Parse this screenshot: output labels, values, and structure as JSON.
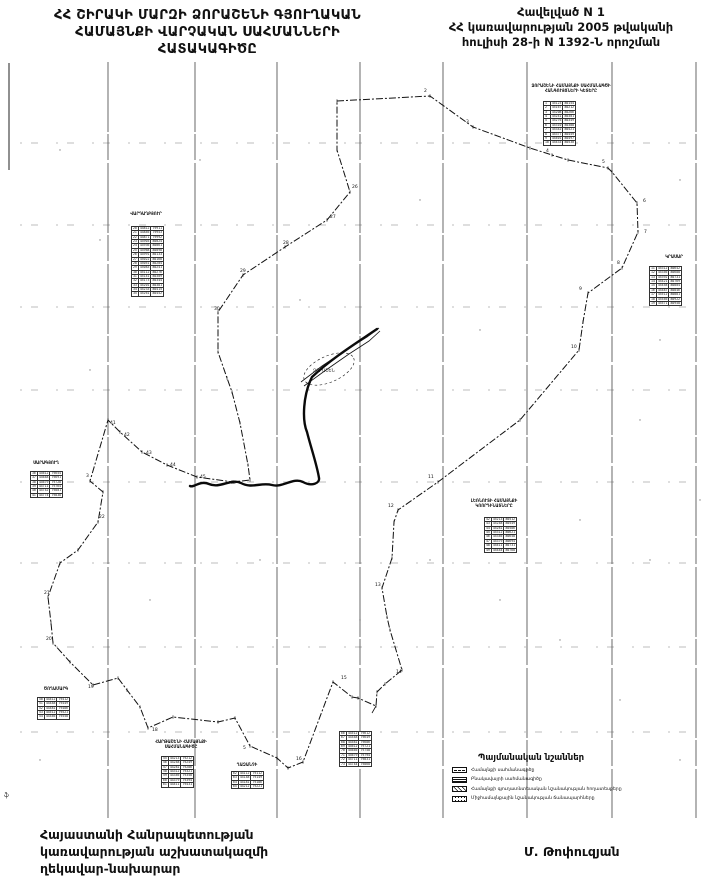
{
  "page": {
    "title_lines": [
      "ՀՀ ՇԻՐԱԿԻ ՄԱՐԶԻ ՁՈՐԱՇԵՆԻ ԳՅՈՒՂԱԿԱՆ",
      "ՀԱՄԱՅՆՔԻ ՎԱՐՉԱԿԱՆ  ՍԱՀՄԱՆՆԵՐԻ",
      "ՀԱՏԱԿԱԳԻԾԸ"
    ],
    "annex_lines": [
      "Հավելված N 1",
      "ՀՀ կառավարության 2005 թվականի",
      "հուլիսի 28-ի N 1392-Ն որոշման"
    ],
    "footer_left_lines": [
      "Հայաստանի Հանրապետության",
      "կառավարության աշխատակազմի",
      "ղեկավար-նախարար"
    ],
    "signature": "Մ. Թոփուզյան",
    "edge_mark": "ֆ"
  },
  "map": {
    "village_label": "ՁՈՐԱՇԵՆ",
    "grid": {
      "vertical_x": [
        108,
        195,
        277,
        360,
        443,
        527,
        612,
        696
      ],
      "v_top": 62,
      "v_bottom": 818,
      "horizontal_y": [
        143,
        225,
        307,
        390,
        482,
        563,
        647,
        732
      ]
    },
    "boundary": [
      [
        337,
        101
      ],
      [
        430,
        96
      ],
      [
        473,
        127
      ],
      [
        530,
        148
      ],
      [
        552,
        155
      ],
      [
        568,
        160
      ],
      [
        608,
        168
      ],
      [
        612,
        172
      ],
      [
        637,
        203
      ],
      [
        638,
        232
      ],
      [
        622,
        268
      ],
      [
        588,
        293
      ],
      [
        583,
        322
      ],
      [
        579,
        350
      ],
      [
        520,
        420
      ],
      [
        438,
        482
      ],
      [
        398,
        510
      ],
      [
        394,
        522
      ],
      [
        392,
        558
      ],
      [
        382,
        588
      ],
      [
        387,
        617
      ],
      [
        390,
        630
      ],
      [
        402,
        670
      ],
      [
        385,
        684
      ],
      [
        377,
        692
      ],
      [
        376,
        706
      ],
      [
        358,
        698
      ],
      [
        352,
        697
      ],
      [
        333,
        682
      ],
      [
        303,
        762
      ],
      [
        288,
        768
      ],
      [
        277,
        758
      ],
      [
        250,
        746
      ],
      [
        235,
        718
      ],
      [
        218,
        722
      ],
      [
        173,
        717
      ],
      [
        148,
        728
      ],
      [
        140,
        707
      ],
      [
        127,
        690
      ],
      [
        118,
        678
      ],
      [
        93,
        685
      ],
      [
        70,
        662
      ],
      [
        53,
        643
      ],
      [
        51,
        623
      ],
      [
        48,
        597
      ],
      [
        60,
        563
      ],
      [
        78,
        550
      ],
      [
        98,
        522
      ],
      [
        103,
        492
      ],
      [
        90,
        481
      ],
      [
        108,
        420
      ],
      [
        120,
        432
      ],
      [
        142,
        452
      ],
      [
        167,
        465
      ],
      [
        197,
        477
      ],
      [
        233,
        482
      ],
      [
        250,
        480
      ],
      [
        248,
        465
      ],
      [
        240,
        423
      ],
      [
        232,
        392
      ],
      [
        227,
        378
      ],
      [
        218,
        352
      ],
      [
        218,
        312
      ],
      [
        243,
        275
      ],
      [
        285,
        247
      ],
      [
        327,
        220
      ],
      [
        350,
        192
      ],
      [
        337,
        150
      ]
    ],
    "bold_paths": [
      "M377,329 C358,342 332,358 312,377 C303,395 302,420 307,432 C311,448 317,465 319,478 C320,483 312,487 303,482 C293,477 283,488 272,485 C261,482 252,489 241,483 C231,478 220,489 209,484 C200,480 194,488 190,486"
    ],
    "thin_paths": [
      "M301,382 L322,366 L346,350 L367,337 L379,328",
      "M304,386 L326,370 L349,354 L369,341 L380,331",
      "M376,706 L372,713"
    ],
    "village_ellipse": {
      "cx": 329,
      "cy": 369,
      "rx": 27,
      "ry": 13,
      "rot": -24
    },
    "point_labels": [
      [
        424,
        92,
        "2"
      ],
      [
        466,
        123,
        "3"
      ],
      [
        546,
        152,
        "4"
      ],
      [
        602,
        163,
        "5"
      ],
      [
        643,
        202,
        "6"
      ],
      [
        644,
        233,
        "7"
      ],
      [
        617,
        264,
        "8"
      ],
      [
        579,
        290,
        "9"
      ],
      [
        571,
        348,
        "10"
      ],
      [
        428,
        478,
        "11"
      ],
      [
        388,
        507,
        "12"
      ],
      [
        375,
        586,
        "13"
      ],
      [
        396,
        673,
        "14"
      ],
      [
        341,
        679,
        "15"
      ],
      [
        296,
        760,
        "16"
      ],
      [
        243,
        749,
        "5"
      ],
      [
        152,
        731,
        "18"
      ],
      [
        88,
        688,
        "19"
      ],
      [
        46,
        640,
        "20"
      ],
      [
        44,
        594,
        "21"
      ],
      [
        99,
        518,
        "22"
      ],
      [
        86,
        477,
        "3"
      ],
      [
        110,
        424,
        "41"
      ],
      [
        124,
        436,
        "42"
      ],
      [
        146,
        454,
        "43"
      ],
      [
        170,
        466,
        "44"
      ],
      [
        200,
        478,
        "45"
      ],
      [
        230,
        484,
        "46"
      ],
      [
        214,
        310,
        "30"
      ],
      [
        240,
        272,
        "29"
      ],
      [
        283,
        244,
        "28"
      ],
      [
        330,
        218,
        "27"
      ],
      [
        352,
        188,
        "26"
      ]
    ],
    "noise_dots": [
      [
        60,
        150
      ],
      [
        420,
        200
      ],
      [
        660,
        340
      ],
      [
        640,
        420
      ],
      [
        90,
        370
      ],
      [
        300,
        300
      ],
      [
        500,
        600
      ],
      [
        620,
        700
      ],
      [
        680,
        760
      ],
      [
        150,
        600
      ],
      [
        260,
        560
      ],
      [
        430,
        560
      ],
      [
        560,
        640
      ],
      [
        700,
        500
      ],
      [
        40,
        760
      ],
      [
        680,
        180
      ],
      [
        200,
        160
      ],
      [
        580,
        520
      ],
      [
        360,
        620
      ],
      [
        100,
        240
      ],
      [
        650,
        560
      ],
      [
        480,
        330
      ]
    ],
    "edge_line": {
      "x": 9,
      "y1": 63,
      "y2": 170
    }
  },
  "tables": [
    {
      "hx": 525,
      "hy": 84,
      "hw": 92,
      "header_lines": [
        "ՁՈՐԱՇԵՆԻ ՀԱՄԱՅՆՔԻ ՍԱՀՄԱՆԱԳԾԻ",
        "ՀԱՆԳՈՒՅՑՆԵՐԻ ԿԵՏԵՐԸ"
      ],
      "tx": 543,
      "ty": 101,
      "rows": [
        [
          "1",
          "45123",
          "80154"
        ],
        [
          "2",
          "45167",
          "80212"
        ],
        [
          "3",
          "45208",
          "80266"
        ],
        [
          "4",
          "45241",
          "80301"
        ],
        [
          "5",
          "45276",
          "80349"
        ],
        [
          "6",
          "45310",
          "80388"
        ],
        [
          "7",
          "45342",
          "80421"
        ],
        [
          "8",
          "45377",
          "80459"
        ],
        [
          "9",
          "45401",
          "80497"
        ],
        [
          "10",
          "45433",
          "80530"
        ]
      ]
    },
    {
      "hx": 648,
      "hy": 255,
      "hw": 52,
      "header_lines": [
        "ԿՐԱՍԱՐ"
      ],
      "tx": 649,
      "ty": 266,
      "rows": [
        [
          "11",
          "45312",
          "80642"
        ],
        [
          "12",
          "45356",
          "80688"
        ],
        [
          "13",
          "45392",
          "80731"
        ],
        [
          "14",
          "45421",
          "80769"
        ],
        [
          "15",
          "45458",
          "80804"
        ],
        [
          "16",
          "45487",
          "80846"
        ],
        [
          "17",
          "45512",
          "80881"
        ],
        [
          "18",
          "45546",
          "80922"
        ],
        [
          "19",
          "45571",
          "80958"
        ]
      ]
    },
    {
      "hx": 122,
      "hy": 212,
      "hw": 48,
      "header_lines": [
        "ՎԱՐԴԱՂԲՅՈՒՐ"
      ],
      "tx": 131,
      "ty": 226,
      "rows": [
        [
          "20",
          "44812",
          "79911"
        ],
        [
          "21",
          "44846",
          "79953"
        ],
        [
          "22",
          "44871",
          "79992"
        ],
        [
          "23",
          "44903",
          "80024"
        ],
        [
          "24",
          "44936",
          "80061"
        ],
        [
          "25",
          "44968",
          "80098"
        ],
        [
          "26",
          "44991",
          "80133"
        ],
        [
          "27",
          "45022",
          "80168"
        ],
        [
          "28",
          "45051",
          "80204"
        ],
        [
          "29",
          "45083",
          "80241"
        ],
        [
          "30",
          "45112",
          "80276"
        ],
        [
          "31",
          "45141",
          "80309"
        ],
        [
          "32",
          "45173",
          "80344"
        ],
        [
          "33",
          "45201",
          "80381"
        ],
        [
          "34",
          "45233",
          "80415"
        ],
        [
          "35",
          "45261",
          "80452"
        ]
      ]
    },
    {
      "hx": 24,
      "hy": 461,
      "hw": 44,
      "header_lines": [
        "ՍԱՐԱԳՅՈՒՂ"
      ],
      "tx": 30,
      "ty": 471,
      "rows": [
        [
          "36",
          "44612",
          "79654"
        ],
        [
          "37",
          "44648",
          "79691"
        ],
        [
          "38",
          "44679",
          "79728"
        ],
        [
          "39",
          "44711",
          "79764"
        ],
        [
          "40",
          "44742",
          "79801"
        ],
        [
          "41",
          "44774",
          "79838"
        ]
      ]
    },
    {
      "hx": 452,
      "hy": 499,
      "hw": 84,
      "header_lines": [
        "ԼԵՌՆՈՒՏԻ ՀԱՄԱՅՆՔԻ",
        "ԿՈՈՐԴԻՆԱՏՆԵՐԸ"
      ],
      "tx": 484,
      "ty": 517,
      "rows": [
        [
          "42",
          "45213",
          "80512"
        ],
        [
          "43",
          "45248",
          "80549"
        ],
        [
          "44",
          "45281",
          "80586"
        ],
        [
          "45",
          "45312",
          "80621"
        ],
        [
          "46",
          "45346",
          "80658"
        ],
        [
          "47",
          "45379",
          "80694"
        ],
        [
          "48",
          "45411",
          "80731"
        ],
        [
          "49",
          "45444",
          "80768"
        ]
      ]
    },
    {
      "hx": 36,
      "hy": 687,
      "hw": 40,
      "header_lines": [
        "ԾՈՂԱՄԱՐԳ"
      ],
      "tx": 37,
      "ty": 697,
      "rows": [
        [
          "50",
          "44412",
          "79412"
        ],
        [
          "51",
          "44448",
          "79449"
        ],
        [
          "52",
          "44481",
          "79486"
        ],
        [
          "53",
          "44512",
          "79521"
        ],
        [
          "54",
          "44546",
          "79558"
        ]
      ]
    },
    {
      "hx": 152,
      "hy": 740,
      "hw": 58,
      "header_lines": [
        "ՀԱՐԹԱՇԵՆԻ ՀԱՄԱՅՆՔԻ",
        "ՍԱՀՄԱՆԱԳԻԾԸ"
      ],
      "tx": 161,
      "ty": 756,
      "rows": [
        [
          "55",
          "44213",
          "79212"
        ],
        [
          "56",
          "44248",
          "79249"
        ],
        [
          "57",
          "44281",
          "79286"
        ],
        [
          "58",
          "44312",
          "79321"
        ],
        [
          "59",
          "44346",
          "79358"
        ],
        [
          "60",
          "44379",
          "79394"
        ],
        [
          "61",
          "44411",
          "79431"
        ]
      ]
    },
    {
      "hx": 226,
      "hy": 763,
      "hw": 42,
      "header_lines": [
        "ՂԱԶԱՆՉԻ"
      ],
      "tx": 231,
      "ty": 771,
      "rows": [
        [
          "62",
          "44112",
          "79112"
        ],
        [
          "63",
          "44148",
          "79149"
        ],
        [
          "64",
          "44181",
          "79186"
        ],
        [
          "65",
          "44212",
          "79221"
        ]
      ]
    },
    {
      "hx": 339,
      "hy": 726,
      "hw": 40,
      "header_lines": [],
      "tx": 339,
      "ty": 731,
      "rows": [
        [
          "66",
          "44512",
          "79612"
        ],
        [
          "67",
          "44548",
          "79649"
        ],
        [
          "68",
          "44581",
          "79686"
        ],
        [
          "69",
          "44612",
          "79721"
        ],
        [
          "70",
          "44646",
          "79758"
        ],
        [
          "71",
          "44679",
          "79794"
        ],
        [
          "72",
          "44711",
          "79831"
        ],
        [
          "73",
          "44744",
          "79868"
        ]
      ]
    }
  ],
  "legend": {
    "title": "Պայմանական նշաններ",
    "items": [
      {
        "symbol": "dashdot-line-swatch",
        "type": "sym-dashdot",
        "label": "Համայնքի սահմանագիծը"
      },
      {
        "symbol": "dense-lines-swatch",
        "type": "sym-dense",
        "label": "Բնակավայրի սահմանագիծը"
      },
      {
        "symbol": "hatch-swatch",
        "type": "sym-hatch",
        "label": "Համայնքի գյուղատնտեսական նշանակության հողատեսքերը"
      },
      {
        "symbol": "dotted-swatch",
        "type": "sym-dots",
        "label": "Միջհամայնքային նշանակության ճանապարհները"
      }
    ]
  }
}
